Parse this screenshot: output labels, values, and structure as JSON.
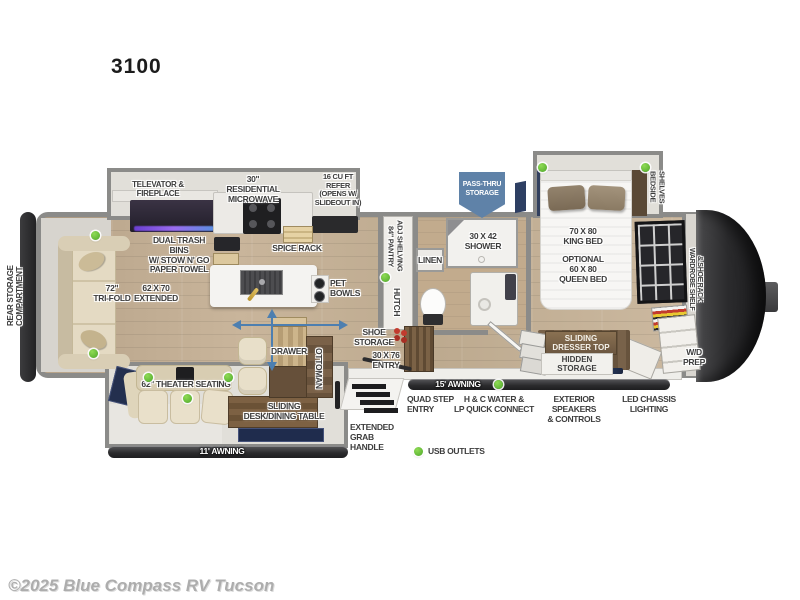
{
  "title": "3100",
  "copyright": "©2025 Blue Compass RV Tucson",
  "legend": {
    "usb": "USB OUTLETS"
  },
  "colors": {
    "usb_dot": "#55b32f",
    "slide_arrow": "#4d7fb0",
    "pass_thru_banner": "#5f82a8",
    "awning_bar": "#2e2e30",
    "label_text": "#3d3d3d",
    "wood_floor": "#c3ae93",
    "wall_gray": "#8b8b89",
    "front_cap": "#2b2b2d"
  },
  "labels": {
    "rear_storage": "REAR STORAGE COMPARTMENT",
    "televator": "TELEVATOR & FIREPLACE",
    "microwave": "30\" RESIDENTIAL\nMICROWAVE",
    "refer": "16 CU FT\nREFER\n(OPENS W/\nSLIDEOUT IN)",
    "trash": "DUAL TRASH BINS\nW/ STOW N' GO\nPAPER TOWEL",
    "spice": "SPICE RACK",
    "pet": "PET\nBOWLS",
    "trifold": "72\"\nTRI-FOLD",
    "extended": "62 x 70\nEXTENDED",
    "pantry": "84\" PANTRY\nADJ SHELVING",
    "hutch": "HUTCH",
    "linen": "LINEN",
    "shower": "30 x 42\nSHOWER",
    "pass_thru": "PASS-THRU\nSTORAGE",
    "king": "70 x 80\nKING BED",
    "queen": "OPTIONAL\n60 x 80\nQUEEN BED",
    "bedside": "BEDSIDE SHELVES",
    "wardrobe": "WARDROBE SHELF\n& SHOE RACK",
    "dresser": "SLIDING\nDRESSER TOP",
    "hidden": "HIDDEN STORAGE",
    "tv": "TV",
    "wd": "W/D\nPREP",
    "shoe": "SHOE\nSTORAGE",
    "entry": "30 x 76\nENTRY",
    "drawer": "DRAWER",
    "ottoman": "OTTOMAN",
    "theater": "62\" THEATER SEATING",
    "desk": "SLIDING\nDESK/DINING TABLE",
    "awning11": "11' AWNING",
    "awning15": "15' AWNING",
    "quad": "QUAD STEP\nENTRY",
    "water": "H & C WATER &\nLP QUICK CONNECT",
    "speakers": "EXTERIOR SPEAKERS\n& CONTROLS",
    "led": "LED CHASSIS\nLIGHTING",
    "grab": "EXTENDED\nGRAB\nHANDLE"
  }
}
